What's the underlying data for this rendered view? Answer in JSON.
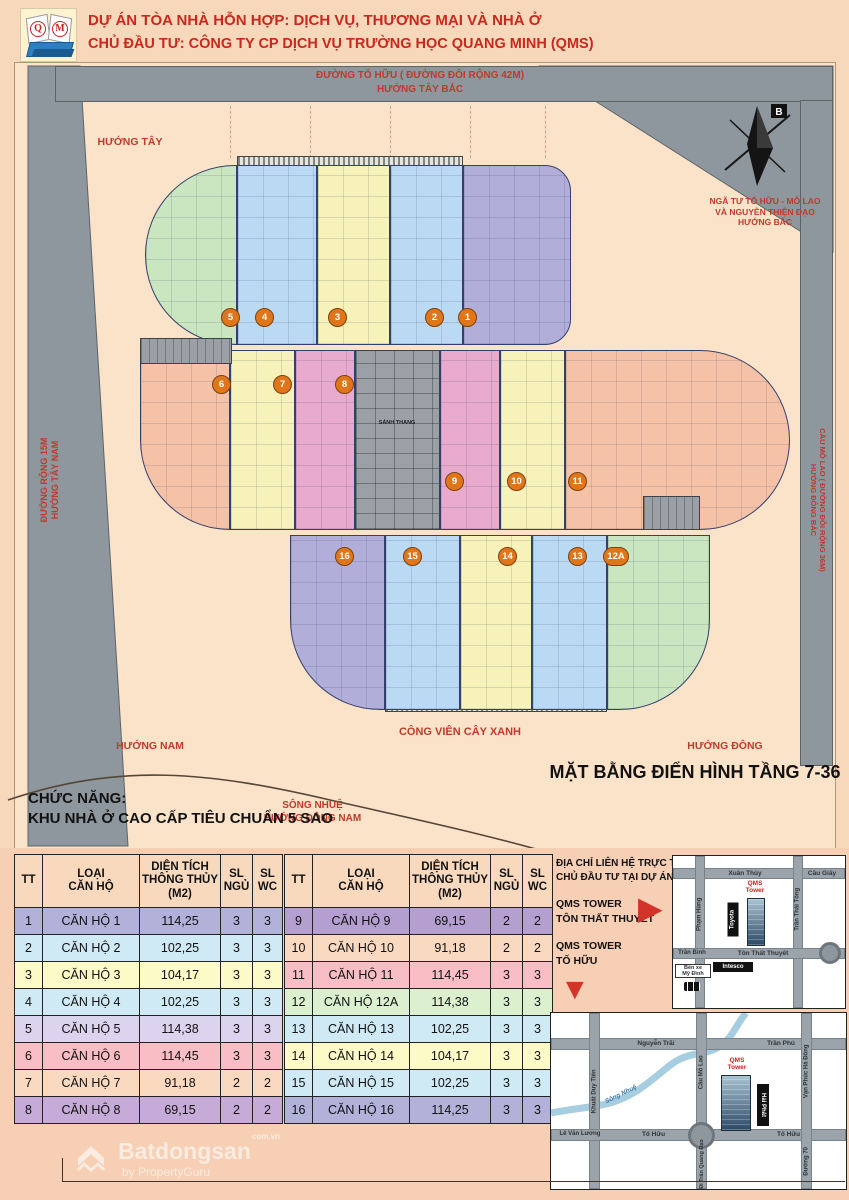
{
  "header": {
    "line1": "DỰ ÁN TÒA NHÀ HỖN HỢP: DỊCH VỤ, THƯƠNG MẠI VÀ NHÀ Ở",
    "line2": "CHỦ ĐẦU TƯ: CÔNG TY CP DỊCH VỤ TRƯỜNG HỌC QUANG MINH (QMS)",
    "logo_q": "Q",
    "logo_m": "M"
  },
  "plan": {
    "title": "MẶT BẰNG ĐIỂN HÌNH TẦNG 7-36",
    "function_label": "CHỨC NĂNG:",
    "function_value": "KHU NHÀ Ở CAO CẤP TIÊU CHUẨN 5 SAO",
    "park_label": "CÔNG VIÊN CÂY XANH",
    "road_top_line1": "ĐƯỜNG TỐ HỮU ( ĐƯỜNG ĐÔI RỘNG 42M)",
    "road_top_line2": "HƯỚNG TÂY BẮC",
    "road_left_line1": "ĐƯỜNG RỘNG 15M",
    "road_left_line2": "HƯỚNG TÂY NAM",
    "road_right_line1": "CẦU MỖ LAO ( ĐƯỜNG ĐÔI RỘNG 36M)",
    "road_right_line2": "HƯỚNG ĐÔNG BẮC",
    "dir_west": "HƯỚNG TÂY",
    "dir_south": "HƯỚNG NAM",
    "dir_east": "HƯỚNG ĐÔNG",
    "dir_southeast_line1": "SÔNG NHUỆ",
    "dir_southeast_line2": "HƯỚNG ĐÔNG NAM",
    "compass_line1": "NGÃ TƯ TỐ HỮU - MỖ LAO",
    "compass_line2": "VÀ NGUYỄN THIỆN ĐẠO",
    "compass_line3": "HƯỚNG BẮC",
    "compass_north": "B",
    "core_label": "SẢNH THANG",
    "logia_label": "LOGIA2",
    "markers": {
      "m1": "1",
      "m2": "2",
      "m3": "3",
      "m4": "4",
      "m5": "5",
      "m6": "6",
      "m7": "7",
      "m8": "8",
      "m9": "9",
      "m10": "10",
      "m11": "11",
      "m12a": "12A",
      "m13": "13",
      "m14": "14",
      "m15": "15",
      "m16": "16"
    },
    "colors": {
      "purple": "#b1aeda",
      "blue": "#b9daf2",
      "yellow": "#f6f2ba",
      "green": "#c9e6c0",
      "salmon": "#f5c2a8",
      "pink": "#e8abcd"
    }
  },
  "tables": {
    "header": {
      "tt": "TT",
      "type": "LOẠI\nCĂN HỘ",
      "area": "DIỆN TÍCH\nTHÔNG THỦY\n(M2)",
      "bed": "SL\nNGỦ",
      "wc": "SL\nWC"
    },
    "left_rows": [
      {
        "tt": "1",
        "name": "CĂN HỘ 1",
        "area": "114,25",
        "bed": "3",
        "wc": "3",
        "color": "#b2b1da"
      },
      {
        "tt": "2",
        "name": "CĂN HỘ 2",
        "area": "102,25",
        "bed": "3",
        "wc": "3",
        "color": "#cfeaf4"
      },
      {
        "tt": "3",
        "name": "CĂN HỘ 3",
        "area": "104,17",
        "bed": "3",
        "wc": "3",
        "color": "#fcfac6"
      },
      {
        "tt": "4",
        "name": "CĂN HỘ 4",
        "area": "102,25",
        "bed": "3",
        "wc": "3",
        "color": "#cfeaf4"
      },
      {
        "tt": "5",
        "name": "CĂN HỘ 5",
        "area": "114,38",
        "bed": "3",
        "wc": "3",
        "color": "#dcd4ee"
      },
      {
        "tt": "6",
        "name": "CĂN HỘ 6",
        "area": "114,45",
        "bed": "3",
        "wc": "3",
        "color": "#f9bdc5"
      },
      {
        "tt": "7",
        "name": "CĂN HỘ 7",
        "area": "91,18",
        "bed": "2",
        "wc": "2",
        "color": "#f9d9c0"
      },
      {
        "tt": "8",
        "name": "CĂN HỘ 8",
        "area": "69,15",
        "bed": "2",
        "wc": "2",
        "color": "#c6abd8"
      }
    ],
    "right_rows": [
      {
        "tt": "9",
        "name": "CĂN HỘ 9",
        "area": "69,15",
        "bed": "2",
        "wc": "2",
        "color": "#b59fd0"
      },
      {
        "tt": "10",
        "name": "CĂN HỘ 10",
        "area": "91,18",
        "bed": "2",
        "wc": "2",
        "color": "#f9d9c0"
      },
      {
        "tt": "11",
        "name": "CĂN HỘ 11",
        "area": "114,45",
        "bed": "3",
        "wc": "3",
        "color": "#f9bdc5"
      },
      {
        "tt": "12",
        "name": "CĂN HỘ 12A",
        "area": "114,38",
        "bed": "3",
        "wc": "3",
        "color": "#daf0cf"
      },
      {
        "tt": "13",
        "name": "CĂN HỘ 13",
        "area": "102,25",
        "bed": "3",
        "wc": "3",
        "color": "#cfeaf4"
      },
      {
        "tt": "14",
        "name": "CĂN HỘ 14",
        "area": "104,17",
        "bed": "3",
        "wc": "3",
        "color": "#fcfac6"
      },
      {
        "tt": "15",
        "name": "CĂN HỘ 15",
        "area": "102,25",
        "bed": "3",
        "wc": "3",
        "color": "#cfeaf4"
      },
      {
        "tt": "16",
        "name": "CĂN HỘ 16",
        "area": "114,25",
        "bed": "3",
        "wc": "3",
        "color": "#b2b1da"
      }
    ]
  },
  "contact": {
    "line1": "ĐỊA CHỈ LIÊN HỆ TRỰC TIẾP",
    "line2": "CHỦ ĐẦU TƯ TẠI DỰ ÁN:",
    "site1_line1": "QMS TOWER",
    "site1_line2": "TÔN THẤT THUYẾT",
    "site2_line1": "QMS TOWER",
    "site2_line2": "TỐ HỮU"
  },
  "icons": {
    "arrow_right": "▶",
    "arrow_down": "▼"
  },
  "maps": {
    "map1": {
      "xuan_thuy": "Xuân Thủy",
      "cau_giay": "Cầu Giấy",
      "pham_hung": "Phạm Hùng",
      "tran_thai_tong": "Trần Thái Tông",
      "tran_binh": "Trần Bình",
      "ton_that_thuyet": "Tôn Thất Thuyết",
      "ben_xe": "Bến xe\nMỹ Đình",
      "toyota": "Toyota",
      "intesco": "Intesco",
      "qms": "QMS\nTower"
    },
    "map2": {
      "nguyen_trai": "Nguyễn Trãi",
      "tran_phu": "Trần Phú",
      "khuat_duy_tien": "Khuất Duy Tiến",
      "cau_mo_lao": "Cầu Mỗ Lao",
      "song_nhue": "Sông Nhuệ",
      "le_van_luong": "Lê Văn Lương",
      "to_huu_1": "Tố Hữu",
      "to_huu_2": "Tố Hữu",
      "di_tran_quang_dao": "Đi Trần Quang Đạo",
      "duong_70": "Đường 70",
      "van_phuc": "Vạn Phúc Hà Đông",
      "hai_phat": "Hải Phát",
      "qms": "QMS\nTower"
    }
  },
  "watermark": {
    "brand": "Batdongsan",
    "suffix": "com.vn",
    "by": "by PropertyGuru"
  }
}
